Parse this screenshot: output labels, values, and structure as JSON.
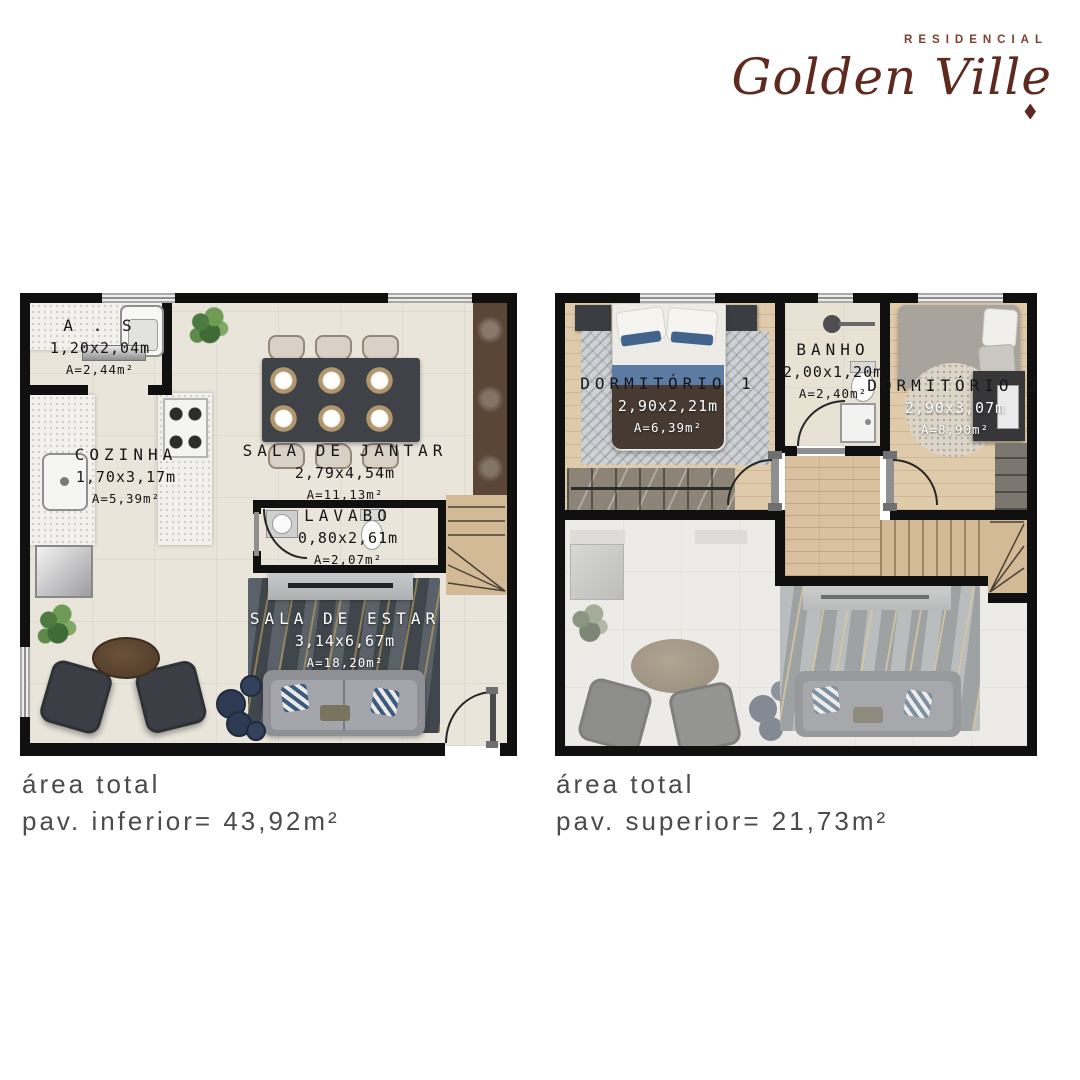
{
  "brand": {
    "residencial": "RESIDENCIAL",
    "name": "Golden Ville",
    "diamond": "◆",
    "color": "#5e2a20"
  },
  "floorplans": {
    "inferior": {
      "rooms": {
        "as": {
          "name": "A . S",
          "dims": "1,20x2,04m",
          "area": "A=2,44m²"
        },
        "cozinha": {
          "name": "COZINHA",
          "dims": "1,70x3,17m",
          "area": "A=5,39m²"
        },
        "sala_jantar": {
          "name": "SALA DE JANTAR",
          "dims": "2,79x4,54m",
          "area": "A=11,13m²"
        },
        "lavabo": {
          "name": "LAVABO",
          "dims": "0,80x2,61m",
          "area": "A=2,07m²"
        },
        "sala_estar": {
          "name": "SALA DE ESTAR",
          "dims": "3,14x6,67m",
          "area": "A=18,20m²"
        }
      },
      "caption": {
        "line1": "área total",
        "line2": "pav. inferior= 43,92m²"
      }
    },
    "superior": {
      "rooms": {
        "dormitorio1": {
          "name": "DORMITÓRIO 1",
          "dims": "2,90x2,21m",
          "area": "A=6,39m²"
        },
        "banho": {
          "name": "BANHO",
          "dims": "2,00x1,20m",
          "area": "A=2,40m²"
        },
        "dormitorio2": {
          "name": "DORMITÓRIO 2",
          "dims": "2,90x3,07m",
          "area": "A=8,90m²"
        }
      },
      "caption": {
        "line1": "área total",
        "line2": "pav. superior= 21,73m²"
      }
    }
  }
}
